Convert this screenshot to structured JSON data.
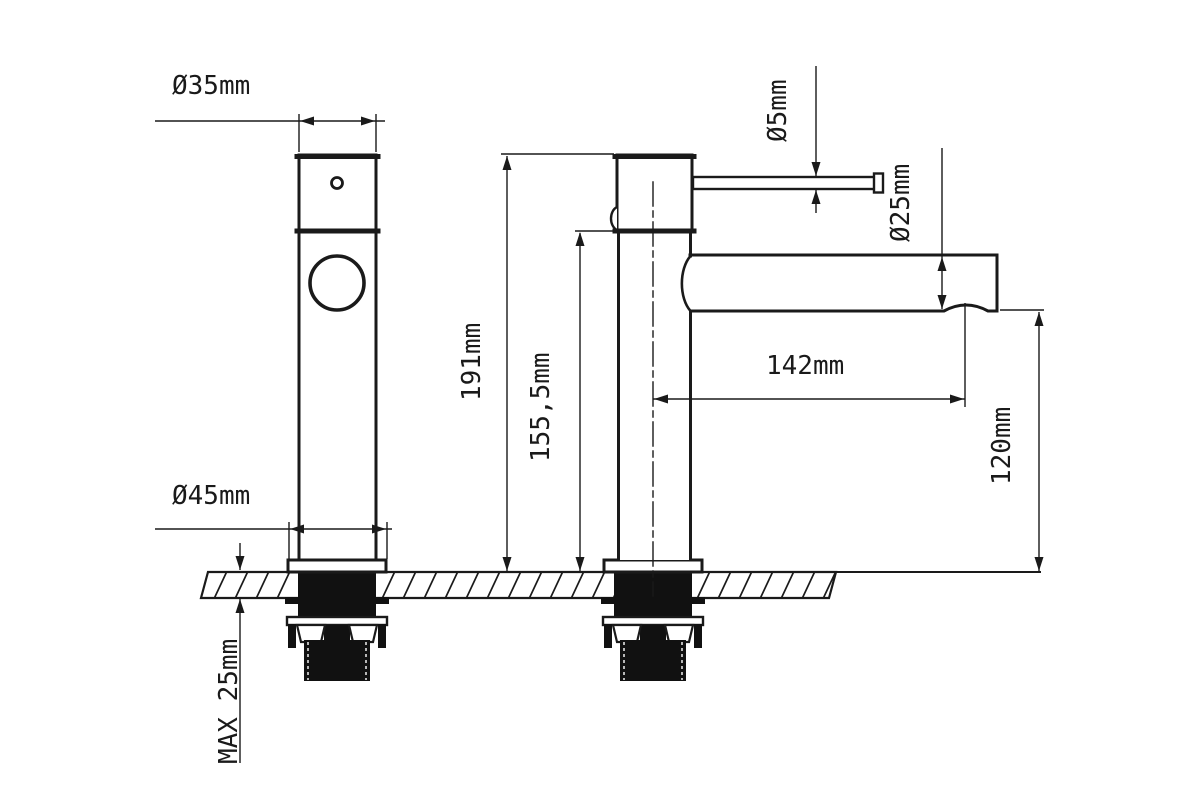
{
  "drawing": {
    "colors": {
      "line": "#1a1a1a",
      "background": "#ffffff"
    },
    "dimensions": {
      "top_diameter": "Ø35mm",
      "base_diameter": "Ø45mm",
      "handle_rod_diameter": "Ø5mm",
      "spout_diameter": "Ø25mm",
      "total_height": "191mm",
      "height_under_spout_top": "155,5mm",
      "spout_reach": "142mm",
      "spout_clearance_height": "120mm",
      "max_mounting_thickness": "MAX 25mm"
    }
  }
}
